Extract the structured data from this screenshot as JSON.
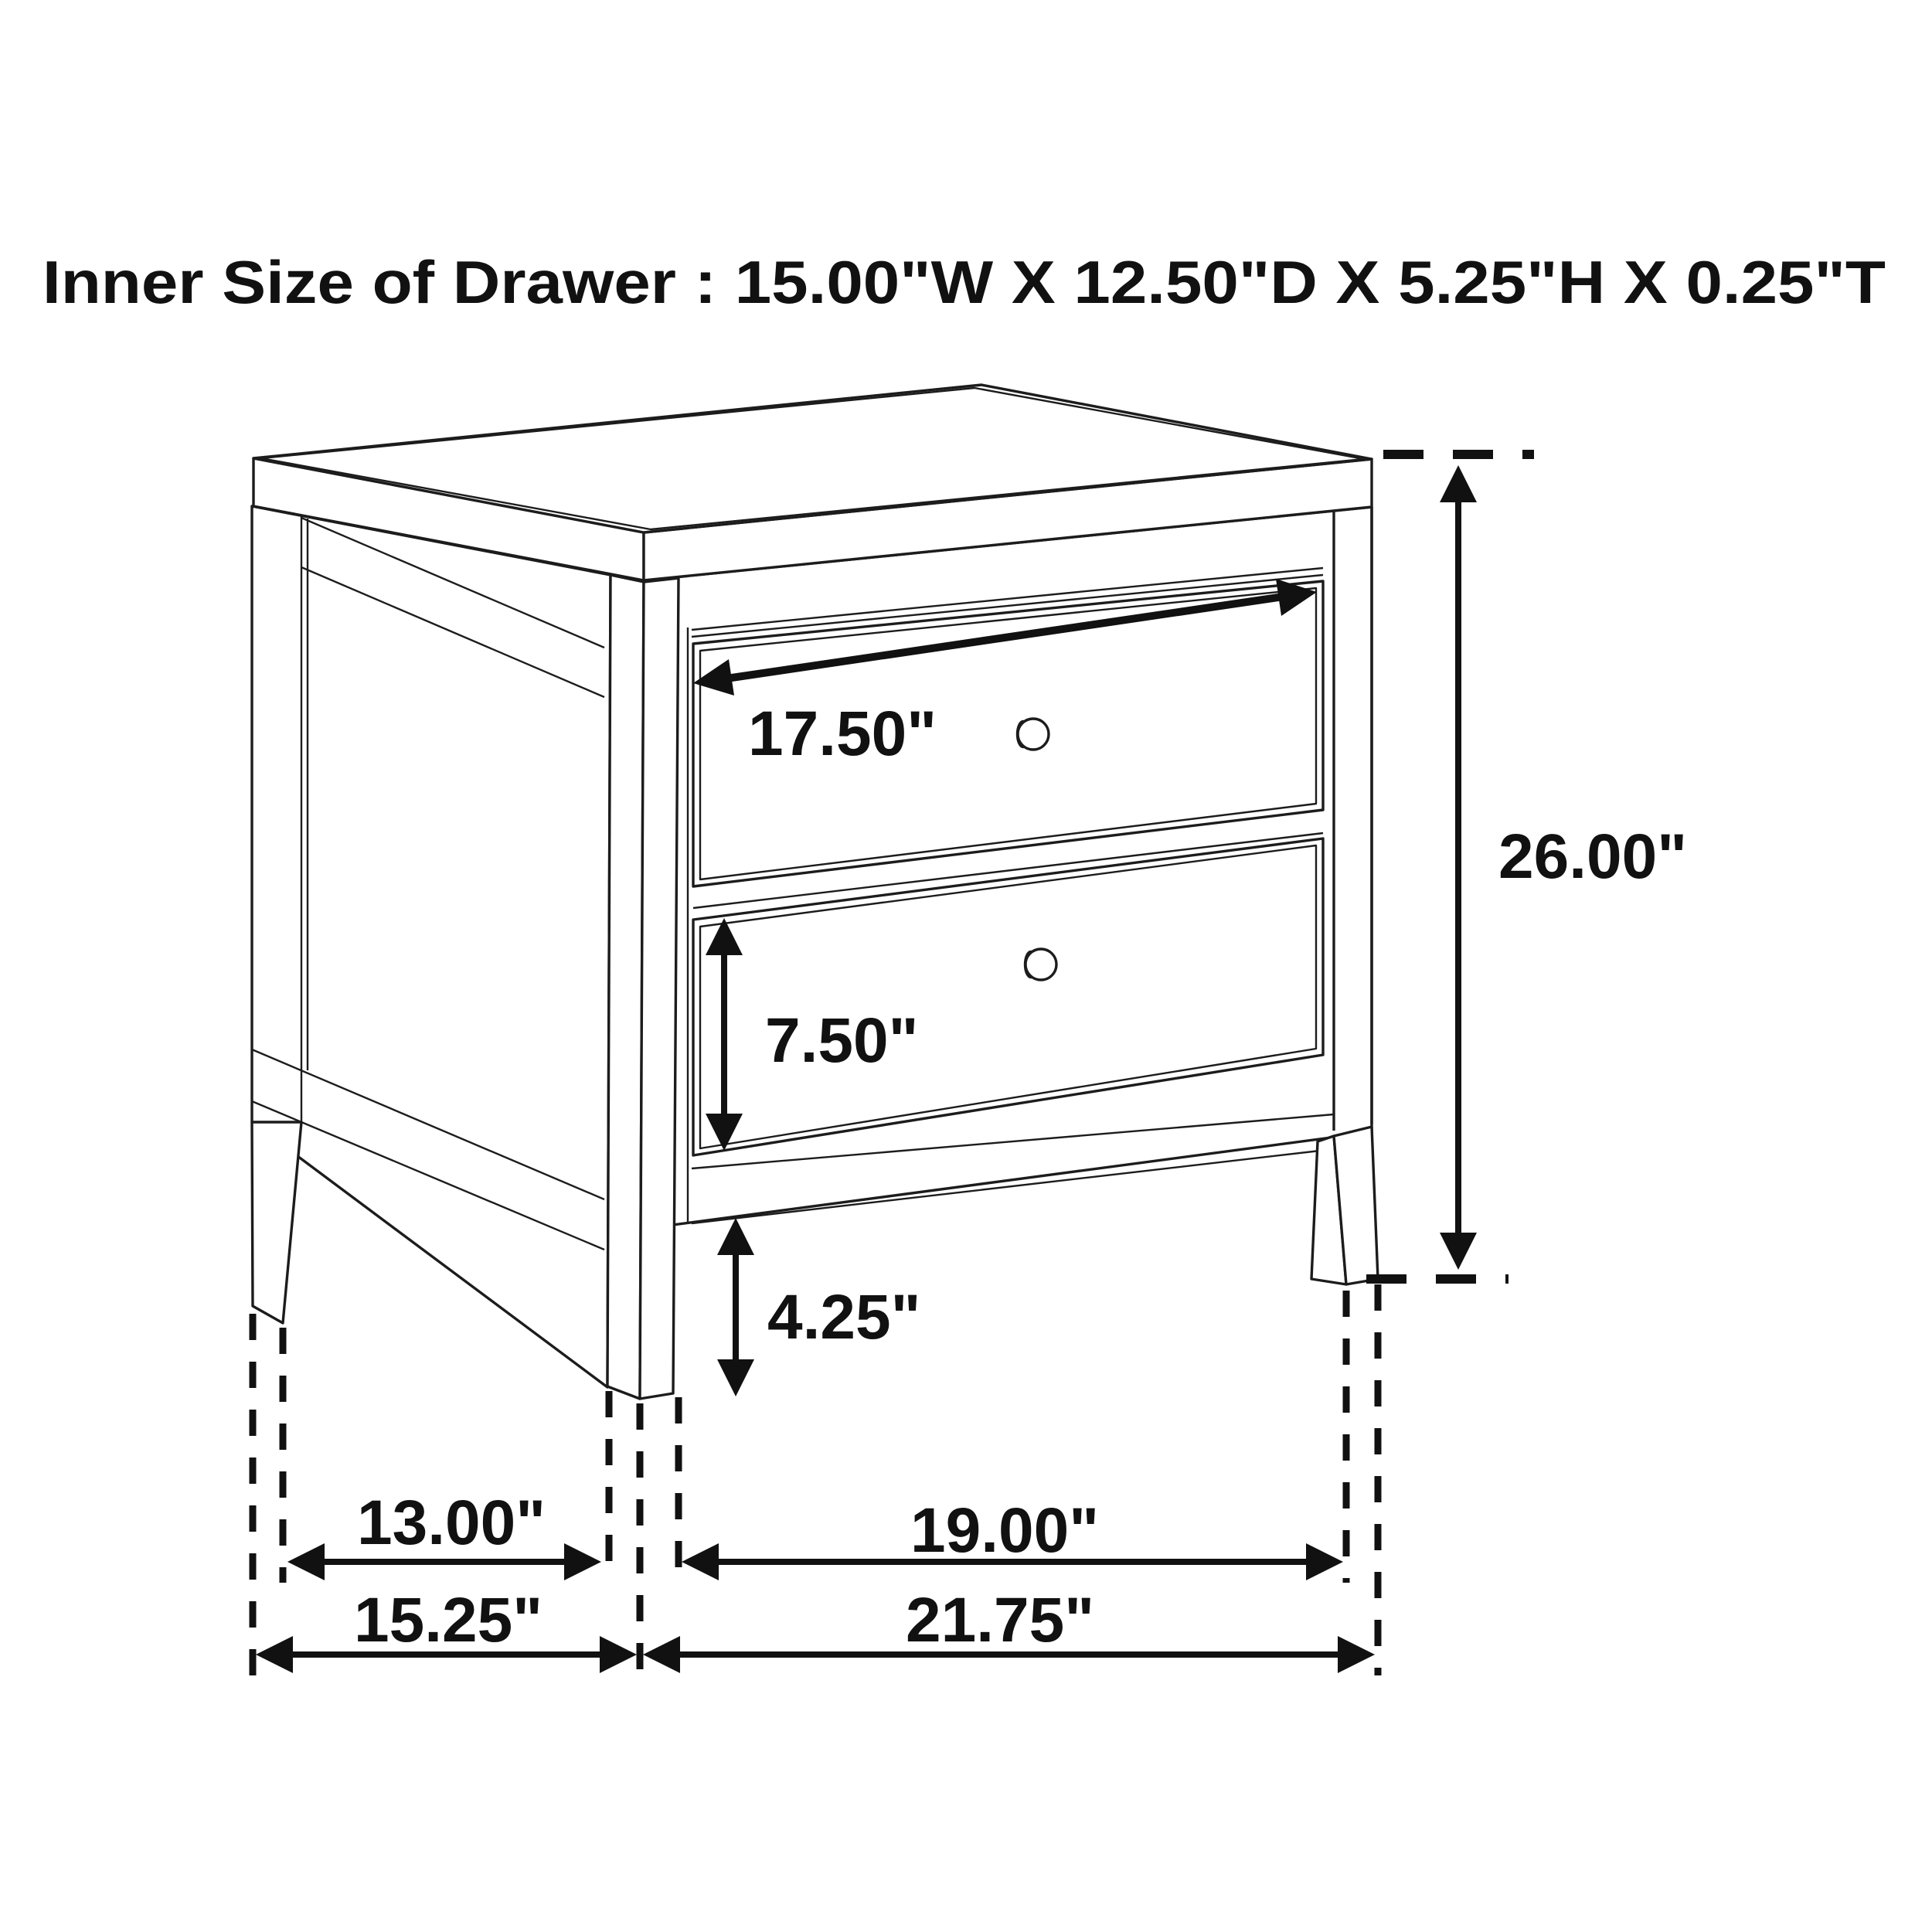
{
  "title": "Inner Size of Drawer : 15.00\"W X 12.50\"D X 5.25\"H X 0.25\"T",
  "dimension_labels": {
    "drawer_front_width": "17.50\"",
    "overall_height": "26.00\"",
    "drawer_front_height": "7.50\"",
    "leg_height": "4.25\"",
    "side_leg_inner_span": "13.00\"",
    "front_leg_inner_span": "19.00\"",
    "side_outer_depth": "15.25\"",
    "front_outer_width": "21.75\""
  }
}
